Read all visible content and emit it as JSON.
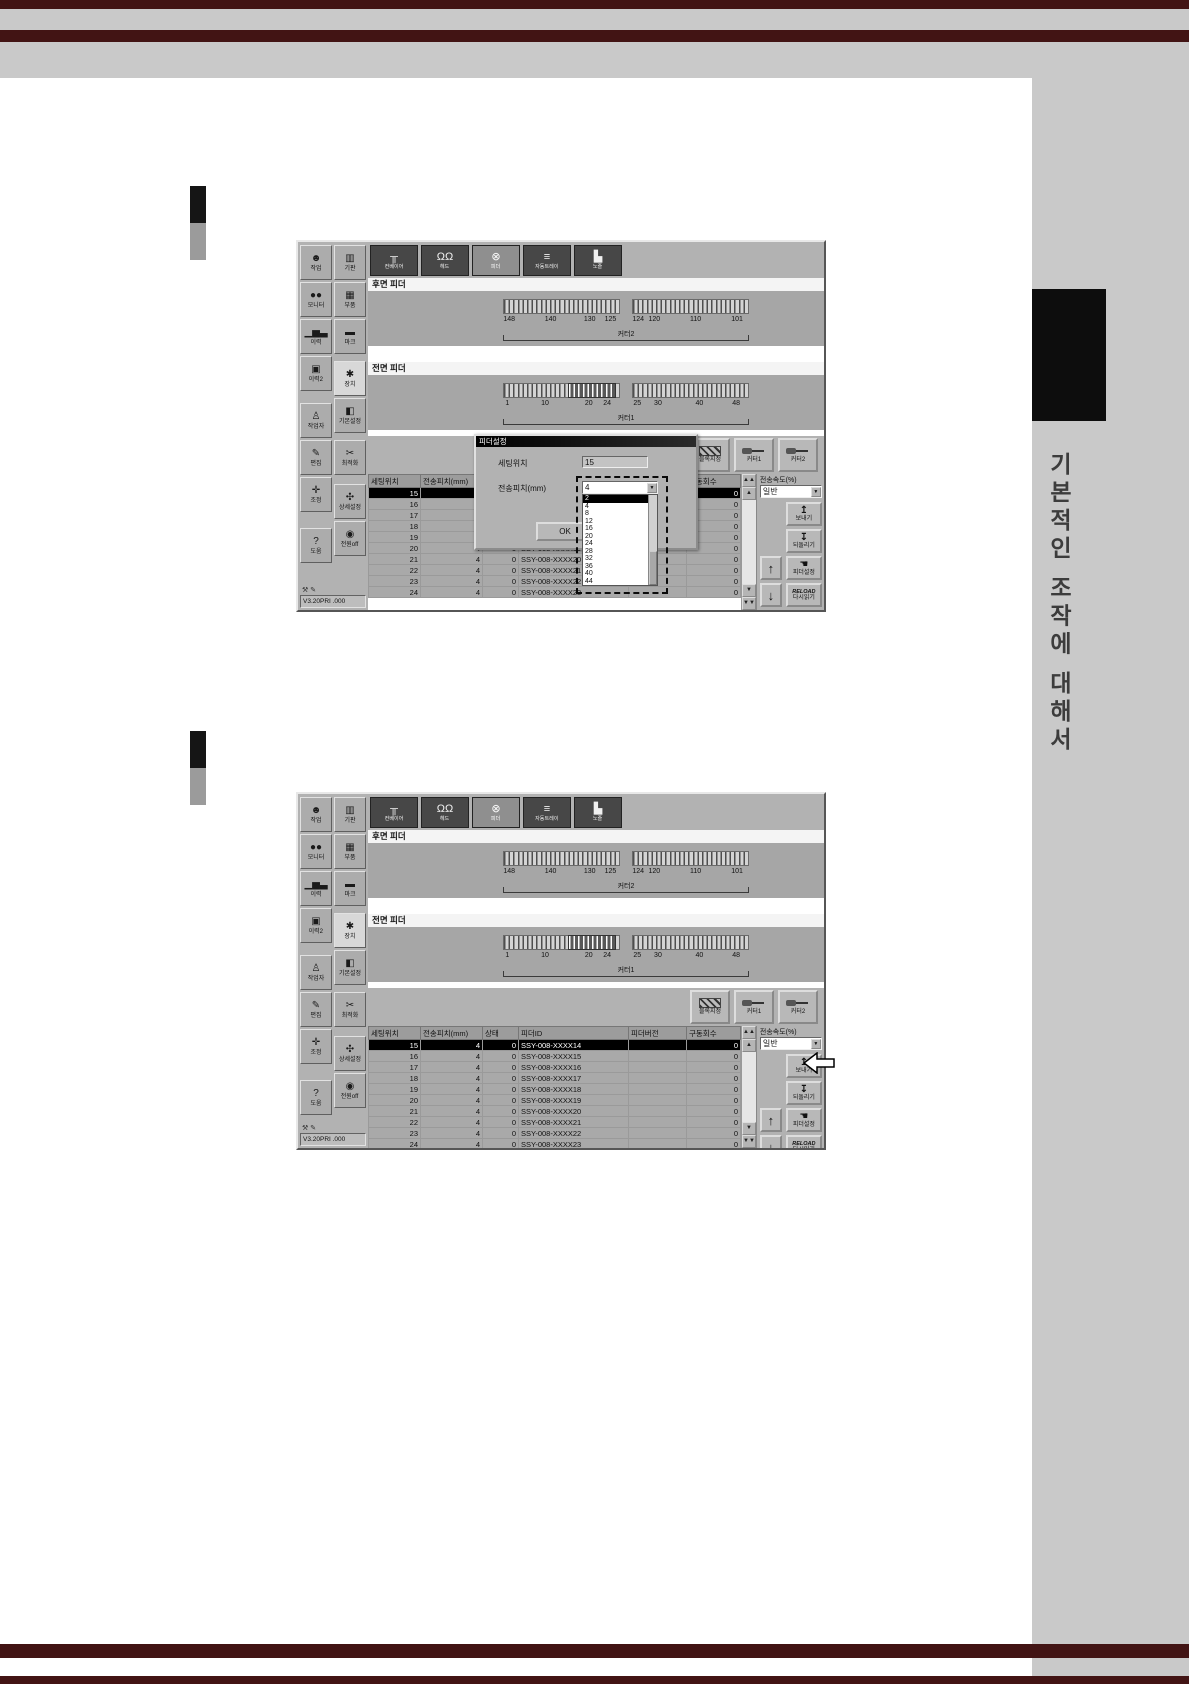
{
  "page": {
    "side_tab_text": "기본적인 조작에 대해서",
    "colors": {
      "band_gray": "#c9c9c9",
      "stripe_maroon": "#421414",
      "tab_black": "#0d0d0d"
    }
  },
  "app": {
    "tabs": [
      {
        "name": "conveyor",
        "label": "컨베이어",
        "glyph": "╥"
      },
      {
        "name": "head",
        "label": "헤드",
        "glyph": "ΩΩ"
      },
      {
        "name": "feeder",
        "label": "피더",
        "glyph": "⊗",
        "selected": true
      },
      {
        "name": "auto-tray",
        "label": "자동트레이",
        "glyph": "≡"
      },
      {
        "name": "nozzle",
        "label": "노즐",
        "glyph": "▙"
      }
    ],
    "sidebar": [
      {
        "name": "job",
        "label": "작업",
        "glyph": "☻"
      },
      {
        "name": "board",
        "label": "기판",
        "glyph": "▥"
      },
      {
        "name": "monitor",
        "label": "모니터",
        "glyph": "●●"
      },
      {
        "name": "parts",
        "label": "부품",
        "glyph": "▦"
      },
      {
        "name": "history",
        "label": "이력",
        "glyph": "▁▅▃"
      },
      {
        "name": "mark",
        "label": "마크",
        "glyph": "▬"
      },
      {
        "name": "history2",
        "label": "이력2",
        "glyph": "▣"
      },
      {
        "name": "device",
        "label": "장치",
        "glyph": "✱",
        "selected": true
      },
      {
        "name": "operator",
        "label": "작업자",
        "glyph": "♙"
      },
      {
        "name": "base-settings",
        "label": "기본설정",
        "glyph": "◧"
      },
      {
        "name": "edit",
        "label": "편집",
        "glyph": "✎"
      },
      {
        "name": "optimize",
        "label": "최적화",
        "glyph": "✂"
      },
      {
        "name": "adjust",
        "label": "조정",
        "glyph": "✛"
      },
      {
        "name": "detail-settings",
        "label": "상세설정",
        "glyph": "✣"
      },
      {
        "name": "help",
        "label": "도움",
        "glyph": "?"
      },
      {
        "name": "power-off",
        "label": "전원off",
        "glyph": "◉"
      }
    ],
    "rear_feeder": {
      "title": "후면 피더",
      "cutter": "커터2",
      "marks_left": [
        {
          "t": "148",
          "pos": "left:2%"
        },
        {
          "t": "140",
          "pos": "left:38%"
        },
        {
          "t": "130",
          "pos": "left:72%"
        },
        {
          "t": "125",
          "pos": "left:90%"
        }
      ],
      "marks_right": [
        {
          "t": "124",
          "pos": "left:2%"
        },
        {
          "t": "120",
          "pos": "left:16%"
        },
        {
          "t": "110",
          "pos": "left:52%"
        },
        {
          "t": "101",
          "pos": "left:88%"
        }
      ]
    },
    "front_feeder": {
      "title": "전면 피더",
      "cutter": "커터1",
      "marks_left": [
        {
          "t": "1",
          "pos": "left:2%"
        },
        {
          "t": "10",
          "pos": "left:34%"
        },
        {
          "t": "20",
          "pos": "left:72%"
        },
        {
          "t": "24",
          "pos": "left:88%"
        }
      ],
      "marks_right": [
        {
          "t": "25",
          "pos": "left:2%"
        },
        {
          "t": "30",
          "pos": "left:20%"
        },
        {
          "t": "40",
          "pos": "left:56%"
        },
        {
          "t": "48",
          "pos": "left:88%"
        }
      ]
    },
    "actions": {
      "block": "블록지정",
      "cutter1": "커터1",
      "cutter2": "커터2"
    },
    "table": {
      "columns": [
        "세팅위치",
        "전송피치(mm)",
        "상태",
        "피더ID",
        "피더버전",
        "구동회수"
      ],
      "rows": [
        {
          "pos": "15",
          "pitch": "4",
          "status": "0",
          "id": "SSY-008-XXXX14",
          "ver": "",
          "count": "0",
          "selected": true
        },
        {
          "pos": "16",
          "pitch": "4",
          "status": "0",
          "id": "SSY-008-XXXX15",
          "ver": "",
          "count": "0"
        },
        {
          "pos": "17",
          "pitch": "4",
          "status": "0",
          "id": "SSY-008-XXXX16",
          "ver": "",
          "count": "0"
        },
        {
          "pos": "18",
          "pitch": "4",
          "status": "0",
          "id": "SSY-008-XXXX17",
          "ver": "",
          "count": "0"
        },
        {
          "pos": "19",
          "pitch": "4",
          "status": "0",
          "id": "SSY-008-XXXX18",
          "ver": "",
          "count": "0"
        },
        {
          "pos": "20",
          "pitch": "4",
          "status": "0",
          "id": "SSY-008-XXXX19",
          "ver": "",
          "count": "0"
        },
        {
          "pos": "21",
          "pitch": "4",
          "status": "0",
          "id": "SSY-008-XXXX20",
          "ver": "",
          "count": "0"
        },
        {
          "pos": "22",
          "pitch": "4",
          "status": "0",
          "id": "SSY-008-XXXX21",
          "ver": "",
          "count": "0"
        },
        {
          "pos": "23",
          "pitch": "4",
          "status": "0",
          "id": "SSY-008-XXXX22",
          "ver": "",
          "count": "0"
        },
        {
          "pos": "24",
          "pitch": "4",
          "status": "0",
          "id": "SSY-008-XXXX23",
          "ver": "",
          "count": "0"
        }
      ]
    },
    "right_panel": {
      "speed_label": "전송속도(%)",
      "speed_value": "일반",
      "send": "보내기",
      "undo": "되돌리기",
      "feeder_setting": "피더설정",
      "reload_word": "RELOAD",
      "reload_label": "다시읽기"
    },
    "status": "V3.20PRI .000"
  },
  "dialog": {
    "title": "피더설정",
    "setting_label": "세팅위치",
    "setting_value": "15",
    "pitch_label": "전송피치(mm)",
    "pitch_value": "4",
    "ok": "OK",
    "options": [
      {
        "t": "2",
        "selected": true
      },
      {
        "t": "4"
      },
      {
        "t": "8"
      },
      {
        "t": "12"
      },
      {
        "t": "16"
      },
      {
        "t": "20"
      },
      {
        "t": "24"
      },
      {
        "t": "28"
      },
      {
        "t": "32"
      },
      {
        "t": "36"
      },
      {
        "t": "40"
      },
      {
        "t": "44"
      }
    ]
  }
}
